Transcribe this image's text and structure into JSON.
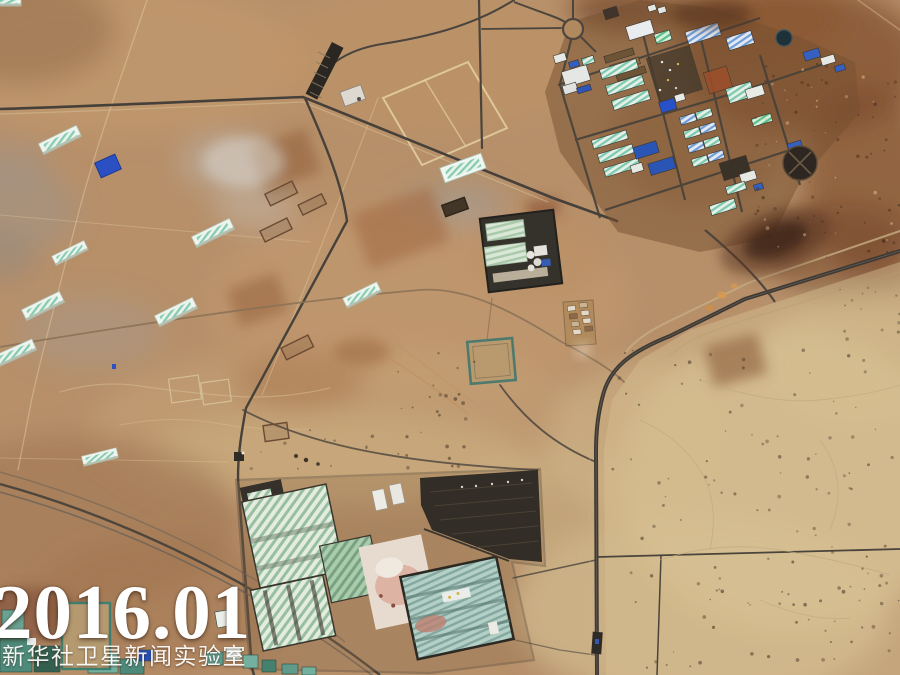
{
  "overlay": {
    "date": "2016.01",
    "watermark": "新华社卫星新闻实验室"
  },
  "palette": {
    "desert_base": "#b7906a",
    "desert_dark": "#8a5a38",
    "desert_light": "#d8c297",
    "road_dark": "#45403a",
    "road_light": "#cdb98f",
    "roof_blue": "#2e56b8",
    "roof_teal": "#8fd0b8",
    "roof_white": "#e9ece8",
    "burn_dark": "#3a2415",
    "field_green": "#5f9a8a",
    "overlay_text": "#ffffff"
  }
}
